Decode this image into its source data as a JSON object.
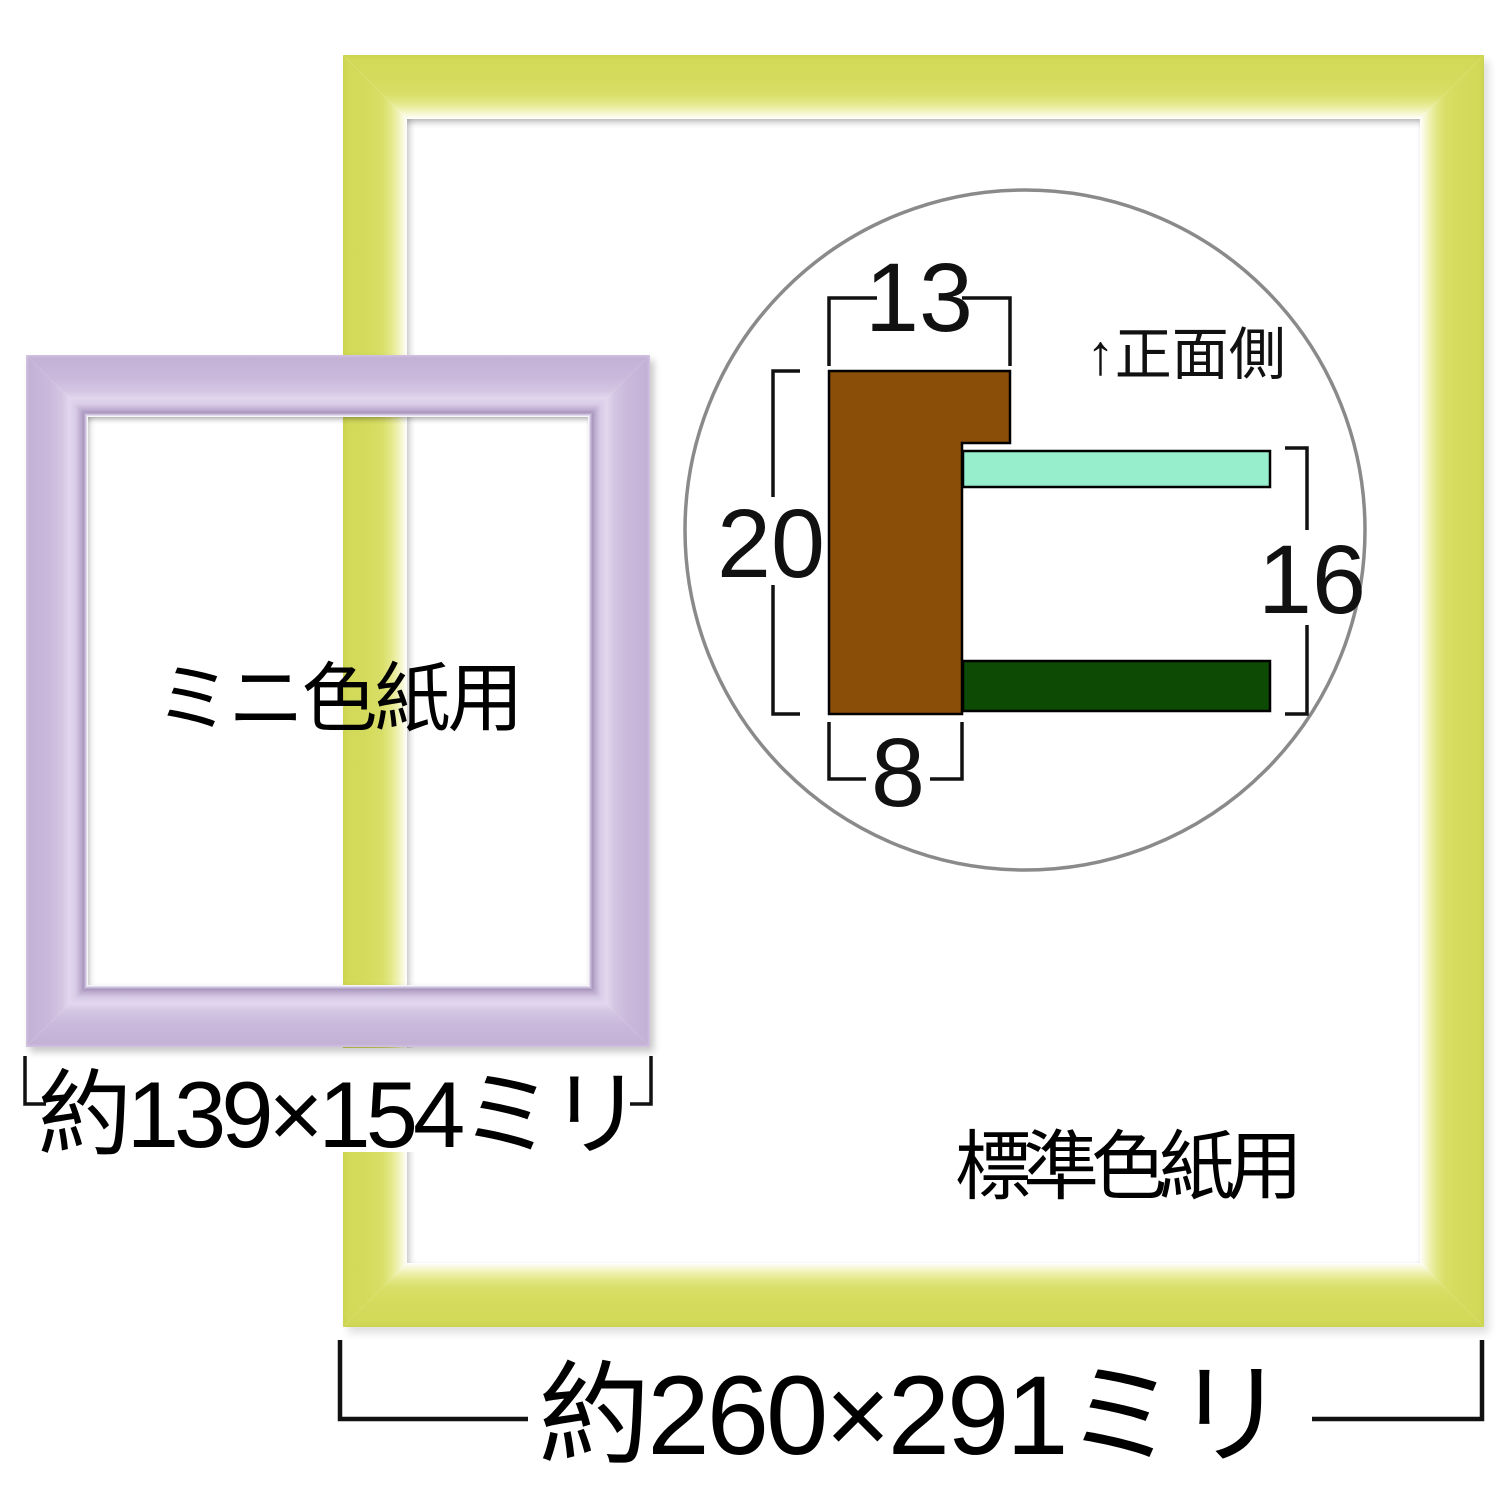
{
  "standard_frame": {
    "label": "標準色紙用",
    "dimension_label": "約260×291ミリ",
    "frame_color": "#d5dc5e"
  },
  "mini_frame": {
    "label": "ミニ色紙用",
    "dimension_label": "約139×154ミリ",
    "frame_color": "#cbb9dc"
  },
  "cross_section": {
    "front_label": "↑正面側",
    "top_width_mm": "13",
    "height_mm": "20",
    "bottom_width_mm": "8",
    "inner_height_mm": "16",
    "moulding_color": "#8a4e08",
    "glass_color": "#96eecd",
    "backboard_color": "#0d4a04",
    "circle_stroke_color": "#8a8a8a"
  }
}
